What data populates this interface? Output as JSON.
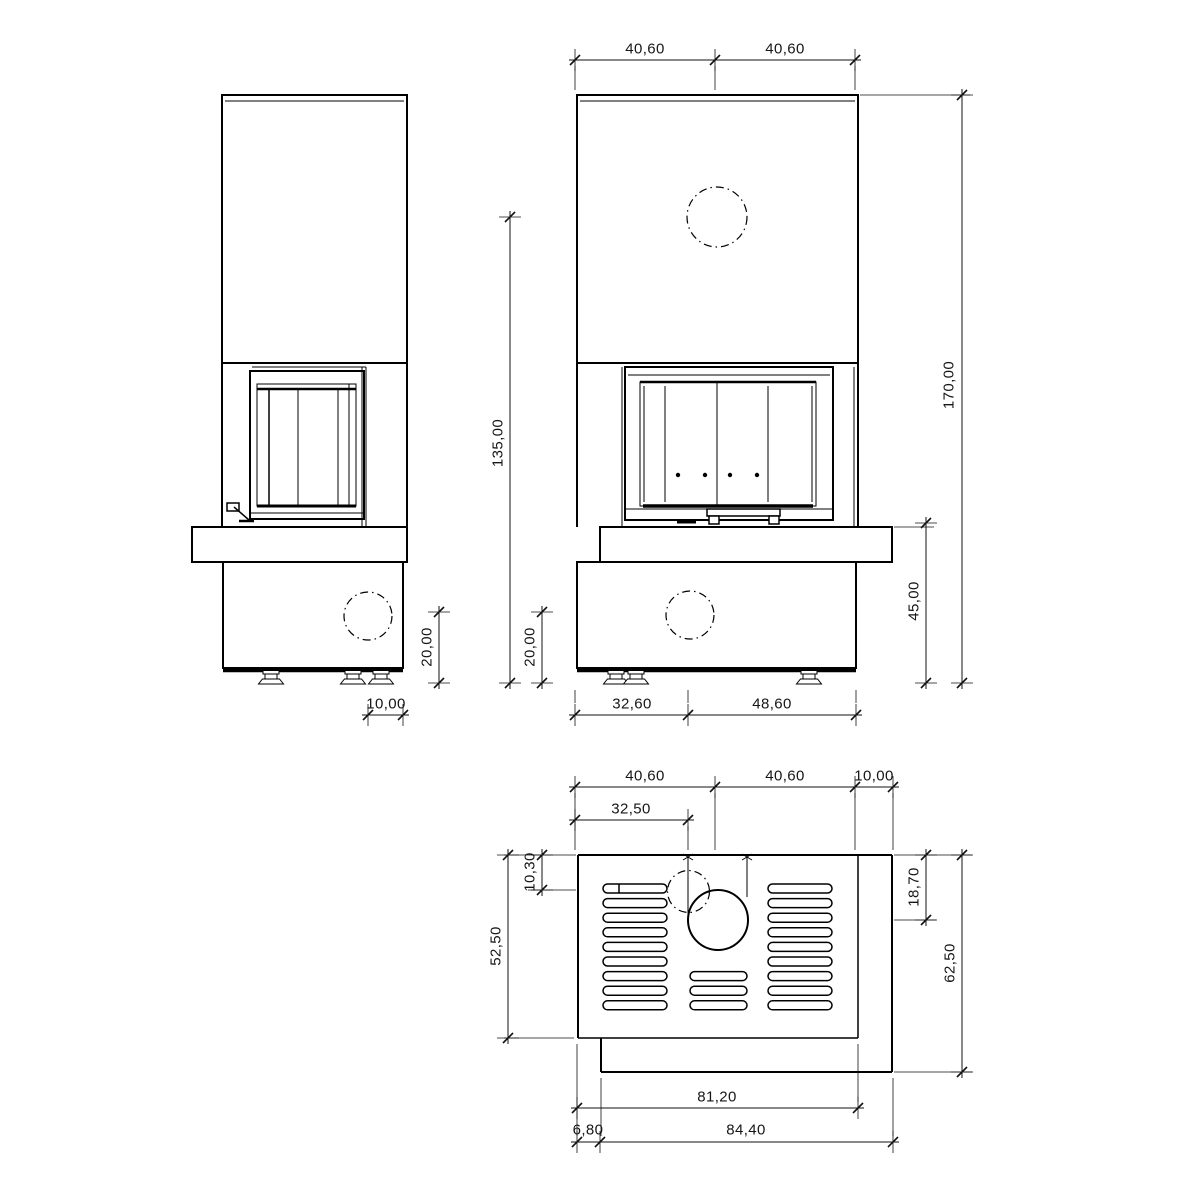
{
  "drawing": {
    "subject": "fireplace-three-view-technical-drawing",
    "background": "#ffffff",
    "line_color": "#000000",
    "dim_color": "#161616",
    "views": {
      "side": "side-view",
      "front": "front-view",
      "plan": "plan-view"
    },
    "dims": {
      "front_top_width_left": "40,60",
      "front_top_width_right": "40,60",
      "firebox_height": "135,00",
      "side_intake_height": "20,00",
      "front_intake_height": "20,00",
      "side_intake_offset": "10,00",
      "total_height": "170,00",
      "bench_height": "45,00",
      "front_base_left": "32,60",
      "front_base_right": "48,60",
      "plan_width_left": "40,60",
      "plan_width_right": "40,60",
      "plan_overhang": "10,00",
      "plan_flue_offset_x": "32,50",
      "plan_intake_offset_y": "10,30",
      "plan_body_depth": "52,50",
      "plan_flue_offset_y": "18,70",
      "plan_total_depth": "62,50",
      "plan_body_width": "81,20",
      "plan_bench_inset": "6,80",
      "plan_bench_width": "84,40"
    }
  }
}
